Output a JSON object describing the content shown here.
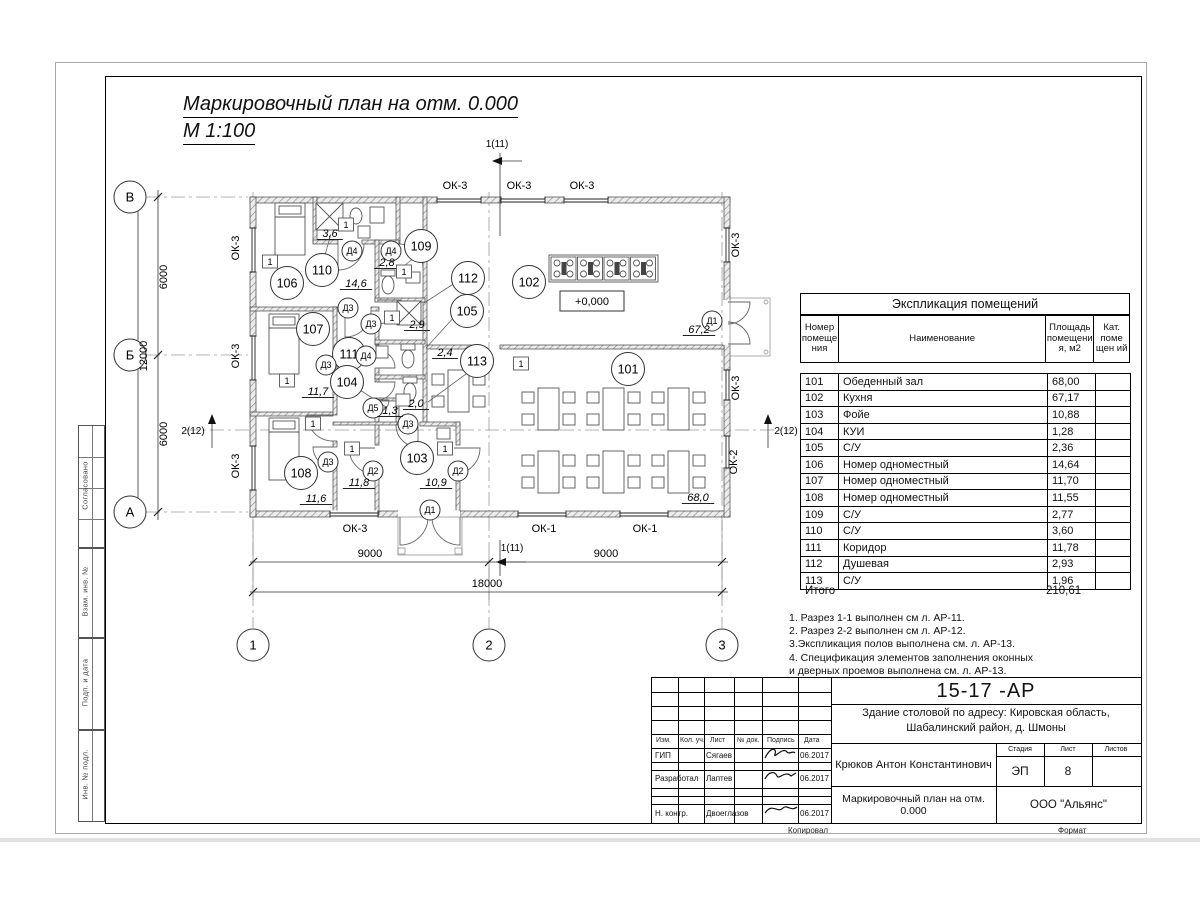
{
  "sheet": {
    "title": "Маркировочный план  на отм. 0.000",
    "scale": "М 1:100",
    "sidebar": [
      "Согласовано",
      "Взам. инв. №",
      "Подп. и дата",
      "Инв. № подл."
    ],
    "footer": {
      "kopiroval": "Копировал",
      "format": "Формат"
    }
  },
  "schedule": {
    "title": "Экспликация помещений",
    "columns": [
      "Номер помеще ния",
      "Наименование",
      "Площадь помещени я, м2",
      "Кат. поме щен ий"
    ],
    "rows": [
      [
        "101",
        "Обеденный зал",
        "68,00",
        ""
      ],
      [
        "102",
        "Кухня",
        "67,17",
        ""
      ],
      [
        "103",
        "Фойе",
        "10,88",
        ""
      ],
      [
        "104",
        "КУИ",
        "1,28",
        ""
      ],
      [
        "105",
        "С/У",
        "2,36",
        ""
      ],
      [
        "106",
        "Номер одноместный",
        "14,64",
        ""
      ],
      [
        "107",
        "Номер одноместный",
        "11,70",
        ""
      ],
      [
        "108",
        "Номер одноместный",
        "11,55",
        ""
      ],
      [
        "109",
        "С/У",
        "2,77",
        ""
      ],
      [
        "110",
        "С/У",
        "3,60",
        ""
      ],
      [
        "111",
        "Коридор",
        "11,78",
        ""
      ],
      [
        "112",
        "Душевая",
        "2,93",
        ""
      ],
      [
        "113",
        "С/У",
        "1,96",
        ""
      ]
    ],
    "total_label": "Итого",
    "total_value": "210,61"
  },
  "notes": [
    "1. Разрез 1-1 выполнен см л. АР-11.",
    "2. Разрез 2-2 выполнен см л. АР-12.",
    "3.Экспликация полов выполнена  см. л. АР-13.",
    "4. Спецификация элементов заполнения оконных",
    " и дверных проемов выполнена  см. л. АР-13."
  ],
  "stamp": {
    "doc_number": "15-17 -АР",
    "object_line1": "Здание столовой по адресу: Кировская область,",
    "object_line2": "Шабалинский район, д. Шмоны",
    "author": "Крюков Антон Константинович",
    "drawing_title": "Маркировочный план  на отм. 0.000",
    "company": "ООО \"Альянс\"",
    "stage_label": "Стадия",
    "sheet_label": "Лист",
    "sheets_label": "Листов",
    "stage": "ЭП",
    "sheet_no": "8",
    "sheets_total": "",
    "cols": [
      "Изм.",
      "Кол. уч.",
      "Лист",
      "№ док.",
      "Подпись",
      "Дата"
    ],
    "rows": [
      {
        "role": "ГИП",
        "name": "Сягаев",
        "date": "06.2017"
      },
      {
        "role": "Разработал",
        "name": "Лаптев",
        "date": "06.2017"
      },
      {
        "role": "Н. контр.",
        "name": "Двоеглазов",
        "date": "06.2017"
      }
    ]
  },
  "plan": {
    "level": "+0,000",
    "bubbles": [
      {
        "t": "106",
        "x": 287,
        "y": 283
      },
      {
        "t": "110",
        "x": 322,
        "y": 270
      },
      {
        "t": "107",
        "x": 313,
        "y": 329
      },
      {
        "t": "108",
        "x": 301,
        "y": 473
      },
      {
        "t": "111",
        "x": 349,
        "y": 354
      },
      {
        "t": "104",
        "x": 347,
        "y": 382
      },
      {
        "t": "109",
        "x": 421,
        "y": 246
      },
      {
        "t": "112",
        "x": 468,
        "y": 278
      },
      {
        "t": "105",
        "x": 467,
        "y": 311
      },
      {
        "t": "113",
        "x": 477,
        "y": 361
      },
      {
        "t": "103",
        "x": 417,
        "y": 458
      },
      {
        "t": "102",
        "x": 529,
        "y": 282
      },
      {
        "t": "101",
        "x": 628,
        "y": 369
      }
    ],
    "door_tags": [
      {
        "t": "Д4",
        "x": 352,
        "y": 251
      },
      {
        "t": "Д4",
        "x": 391,
        "y": 251
      },
      {
        "t": "Д4",
        "x": 366,
        "y": 356
      },
      {
        "t": "Д3",
        "x": 348,
        "y": 308
      },
      {
        "t": "Д3",
        "x": 371,
        "y": 324
      },
      {
        "t": "Д3",
        "x": 326,
        "y": 365
      },
      {
        "t": "Д3",
        "x": 328,
        "y": 462
      },
      {
        "t": "Д3",
        "x": 408,
        "y": 424
      },
      {
        "t": "Д5",
        "x": 373,
        "y": 408
      },
      {
        "t": "Д2",
        "x": 373,
        "y": 471
      },
      {
        "t": "Д2",
        "x": 458,
        "y": 471
      },
      {
        "t": "Д1",
        "x": 430,
        "y": 510
      },
      {
        "t": "Д1",
        "x": 712,
        "y": 321
      }
    ],
    "areas": [
      {
        "t": "3,6",
        "x": 330,
        "y": 237
      },
      {
        "t": "14,6",
        "x": 356,
        "y": 287
      },
      {
        "t": "2,8",
        "x": 387,
        "y": 266
      },
      {
        "t": "2,9",
        "x": 417,
        "y": 328
      },
      {
        "t": "2,4",
        "x": 445,
        "y": 356
      },
      {
        "t": "2,0",
        "x": 416,
        "y": 407
      },
      {
        "t": "1,3",
        "x": 390,
        "y": 414
      },
      {
        "t": "11,7",
        "x": 318,
        "y": 395
      },
      {
        "t": "11,6",
        "x": 316,
        "y": 502
      },
      {
        "t": "11,8",
        "x": 359,
        "y": 486
      },
      {
        "t": "10,9",
        "x": 436,
        "y": 486
      },
      {
        "t": "67,2",
        "x": 699,
        "y": 333
      },
      {
        "t": "68,0",
        "x": 698,
        "y": 501
      }
    ],
    "windows": [
      {
        "t": "ОК-3",
        "x": 455,
        "y": 189
      },
      {
        "t": "ОК-3",
        "x": 519,
        "y": 189
      },
      {
        "t": "ОК-3",
        "x": 582,
        "y": 189
      },
      {
        "t": "ОК-3",
        "x": 355,
        "y": 532
      },
      {
        "t": "ОК-1",
        "x": 544,
        "y": 532
      },
      {
        "t": "ОК-1",
        "x": 645,
        "y": 532
      },
      {
        "t": "ОК-3",
        "x": 239,
        "y": 248,
        "r": -90
      },
      {
        "t": "ОК-3",
        "x": 239,
        "y": 356,
        "r": -90
      },
      {
        "t": "ОК-3",
        "x": 239,
        "y": 466,
        "r": -90
      },
      {
        "t": "ОК-3",
        "x": 739,
        "y": 245,
        "r": -90
      },
      {
        "t": "ОК-3",
        "x": 739,
        "y": 388,
        "r": -90
      },
      {
        "t": "ОК-2",
        "x": 737,
        "y": 462,
        "r": -90
      }
    ],
    "markers": [
      {
        "t": "1",
        "x": 270,
        "y": 262
      },
      {
        "t": "1",
        "x": 346,
        "y": 225
      },
      {
        "t": "1",
        "x": 404,
        "y": 272
      },
      {
        "t": "1",
        "x": 392,
        "y": 318
      },
      {
        "t": "1",
        "x": 287,
        "y": 381
      },
      {
        "t": "1",
        "x": 313,
        "y": 424
      },
      {
        "t": "1",
        "x": 352,
        "y": 449
      },
      {
        "t": "1",
        "x": 445,
        "y": 449
      },
      {
        "t": "1",
        "x": 521,
        "y": 364
      }
    ],
    "dims": [
      {
        "t": "6000",
        "x": 167,
        "y": 277,
        "r": -90
      },
      {
        "t": "6000",
        "x": 167,
        "y": 434,
        "r": -90
      },
      {
        "t": "12000",
        "x": 147,
        "y": 356,
        "r": -90
      },
      {
        "t": "9000",
        "x": 370,
        "y": 557
      },
      {
        "t": "9000",
        "x": 606,
        "y": 557
      },
      {
        "t": "18000",
        "x": 487,
        "y": 587
      }
    ],
    "axes": [
      {
        "t": "В",
        "x": 130,
        "y": 197
      },
      {
        "t": "Б",
        "x": 130,
        "y": 355
      },
      {
        "t": "А",
        "x": 130,
        "y": 512
      },
      {
        "t": "1",
        "x": 253,
        "y": 645
      },
      {
        "t": "2",
        "x": 489,
        "y": 645
      },
      {
        "t": "3",
        "x": 722,
        "y": 645
      }
    ],
    "sections": [
      {
        "t": "1(11)",
        "x": 497,
        "y": 147
      },
      {
        "t": "1(11)",
        "x": 512,
        "y": 551
      },
      {
        "t": "2(12)",
        "x": 193,
        "y": 434
      },
      {
        "t": "2(12)",
        "x": 786,
        "y": 434
      }
    ]
  }
}
